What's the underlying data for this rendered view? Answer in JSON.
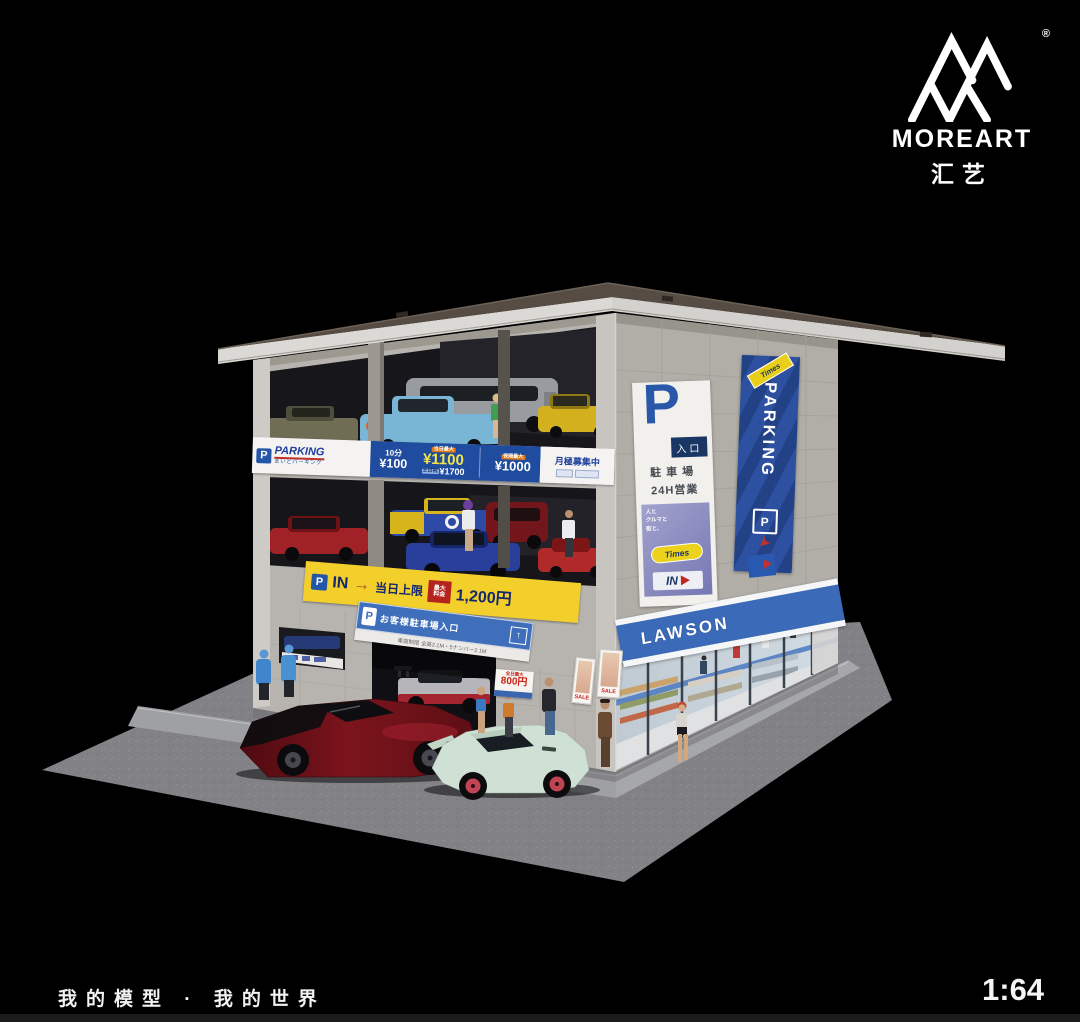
{
  "logo": {
    "brand": "MOREART",
    "registered": "®",
    "chinese": "汇艺"
  },
  "footer": {
    "caption": "我的模型 · 我的世界",
    "scale": "1:64"
  },
  "building": {
    "price_banner": {
      "p": "P",
      "brand": "PARKING",
      "brand_sub": "まいどパーキング",
      "unit_label": "10分",
      "unit_price": "¥100",
      "max_tag": "当日最大",
      "max_price": "¥1100",
      "weekend_tag": "土日祝",
      "weekend_price": "¥1700",
      "night_tag": "夜間最大",
      "night_price": "¥1000",
      "monthly": "月極募集中"
    },
    "entry_banner": {
      "p": "P",
      "in": "IN",
      "arrow": "→",
      "limit": "当日上限",
      "fee_tag_1": "最大",
      "fee_tag_2": "料金",
      "fee": "1,200円"
    },
    "customer_sign": {
      "p": "P",
      "text": "お客様駐車場入口",
      "arrow": "↑",
      "restriction": "車高制限 全高2.1M・5ナンバー2.1M"
    },
    "entrance_panel": {
      "p": "P",
      "gate": "入口",
      "line1": "駐車場",
      "line2": "24H営業"
    },
    "times_poster": {
      "tagline_1": "人と",
      "tagline_2": "クルマと",
      "tagline_3": "街と、",
      "brand": "Times",
      "in": "IN",
      "arrow": "►"
    },
    "vertical_sign": {
      "brand": "Times",
      "text": "PARKING",
      "p": "P",
      "arrow": "➤"
    },
    "lawson": {
      "name": "LAWSON"
    },
    "poster_800": {
      "tag": "全日最大",
      "price": "800円"
    },
    "sale_poster": {
      "text": "SALE"
    }
  },
  "palette": {
    "background": "#000000",
    "roof": "#574c43",
    "wall": "#b7b4af",
    "banner_blue": "#1f4c9e",
    "banner_yellow": "#f2cf2a",
    "lawson_blue": "#3a6ab8",
    "sign_blue": "#2d51a0",
    "accent_red": "#c0281e",
    "car_red": "#7c141c",
    "car_mint": "#cfe0d4"
  }
}
